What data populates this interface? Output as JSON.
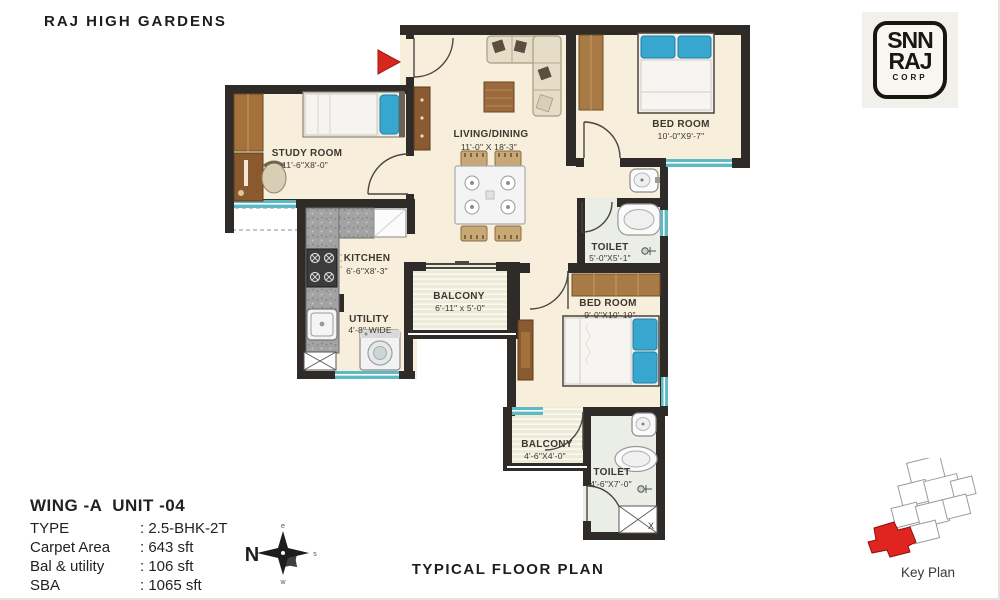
{
  "page": {
    "title": "RAJ HIGH GARDENS",
    "footer": "TYPICAL FLOOR PLAN"
  },
  "logo": {
    "line1": "SNN",
    "line2": "RAJ",
    "line3": "CORP"
  },
  "info": {
    "heading": "WING -A  UNIT -04",
    "rows": [
      {
        "label": "TYPE",
        "value": ": 2.5-BHK-2T"
      },
      {
        "label": "Carpet Area",
        "value": ": 643 sft"
      },
      {
        "label": "Bal & utility",
        "value": ": 106 sft"
      },
      {
        "label": "SBA",
        "value": ": 1065 sft"
      }
    ]
  },
  "rooms": {
    "study": {
      "name": "STUDY ROOM",
      "dims": "11'-6\"X8'-0\""
    },
    "living": {
      "name": "LIVING/DINING",
      "dims": "11'-0\" X 18'-3\""
    },
    "bedroom1": {
      "name": "BED ROOM",
      "dims": "10'-0\"X9'-7\""
    },
    "toilet1": {
      "name": "TOILET",
      "dims": "5'-0\"X5'-1\""
    },
    "kitchen": {
      "name": "KITCHEN",
      "dims": "6'-6\"X8'-3\""
    },
    "utility": {
      "name": "UTILITY",
      "dims": "4'-8\" WIDE"
    },
    "balcony1": {
      "name": "BALCONY",
      "dims": "6'-11\" x 5'-0\""
    },
    "bedroom2": {
      "name": "BED ROOM",
      "dims": "9'-0\"X10'-10\""
    },
    "balcony2": {
      "name": "BALCONY",
      "dims": "4'-6\"X4'-0\""
    },
    "toilet2": {
      "name": "TOILET",
      "dims": "4'-6\"X7'-0\""
    }
  },
  "compass": {
    "north": "N",
    "east": "e",
    "south": "s",
    "west": "w"
  },
  "key_plan": {
    "label": "Key Plan"
  },
  "misc": {
    "duct_label": "X"
  },
  "colors": {
    "wall": "#2f2b28",
    "floor": "#f7efdc",
    "window": "#5fb9c4",
    "accent_red": "#d7281f",
    "wood": "#a4713d"
  }
}
